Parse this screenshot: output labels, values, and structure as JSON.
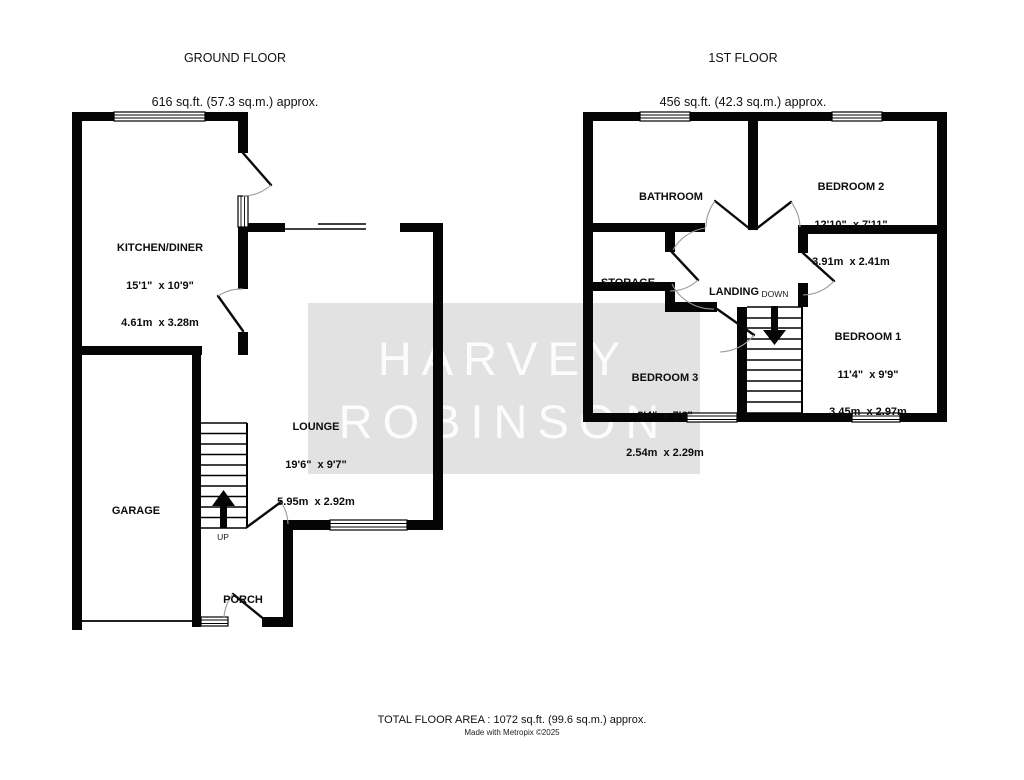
{
  "headers": {
    "ground": {
      "title": "GROUND FLOOR",
      "area": "616 sq.ft. (57.3 sq.m.) approx."
    },
    "first": {
      "title": "1ST FLOOR",
      "area": "456 sq.ft. (42.3 sq.m.) approx."
    }
  },
  "watermark": {
    "line1": "HARVEY",
    "line2": "ROBINSON",
    "box_color": "#e2e2e2",
    "text_color": "#ffffff"
  },
  "ground_floor": {
    "rooms": {
      "kitchen": {
        "name": "KITCHEN/DINER",
        "imperial": "15'1\"  x 10'9\"",
        "metric": "4.61m  x 3.28m"
      },
      "lounge": {
        "name": "LOUNGE",
        "imperial": "19'6\"  x 9'7\"",
        "metric": "5.95m  x 2.92m"
      },
      "garage": {
        "name": "GARAGE"
      },
      "porch": {
        "name": "PORCH"
      }
    },
    "stair_direction": "UP"
  },
  "first_floor": {
    "rooms": {
      "bathroom": {
        "name": "BATHROOM"
      },
      "bedroom2": {
        "name": "BEDROOM 2",
        "imperial": "12'10\"  x 7'11\"",
        "metric": "3.91m  x 2.41m"
      },
      "storage": {
        "name": "STORAGE"
      },
      "landing": {
        "name": "LANDING"
      },
      "bedroom3": {
        "name": "BEDROOM 3",
        "imperial": "8'4\"  x 7'6\"",
        "metric": "2.54m  x 2.29m"
      },
      "bedroom1": {
        "name": "BEDROOM 1",
        "imperial": "11'4\"  x 9'9\"",
        "metric": "3.45m  x 2.97m"
      }
    },
    "stair_direction": "DOWN"
  },
  "footer": {
    "total_area": "TOTAL FLOOR AREA : 1072 sq.ft. (99.6 sq.m.) approx.",
    "credit": "Made with Metropix ©2025"
  }
}
